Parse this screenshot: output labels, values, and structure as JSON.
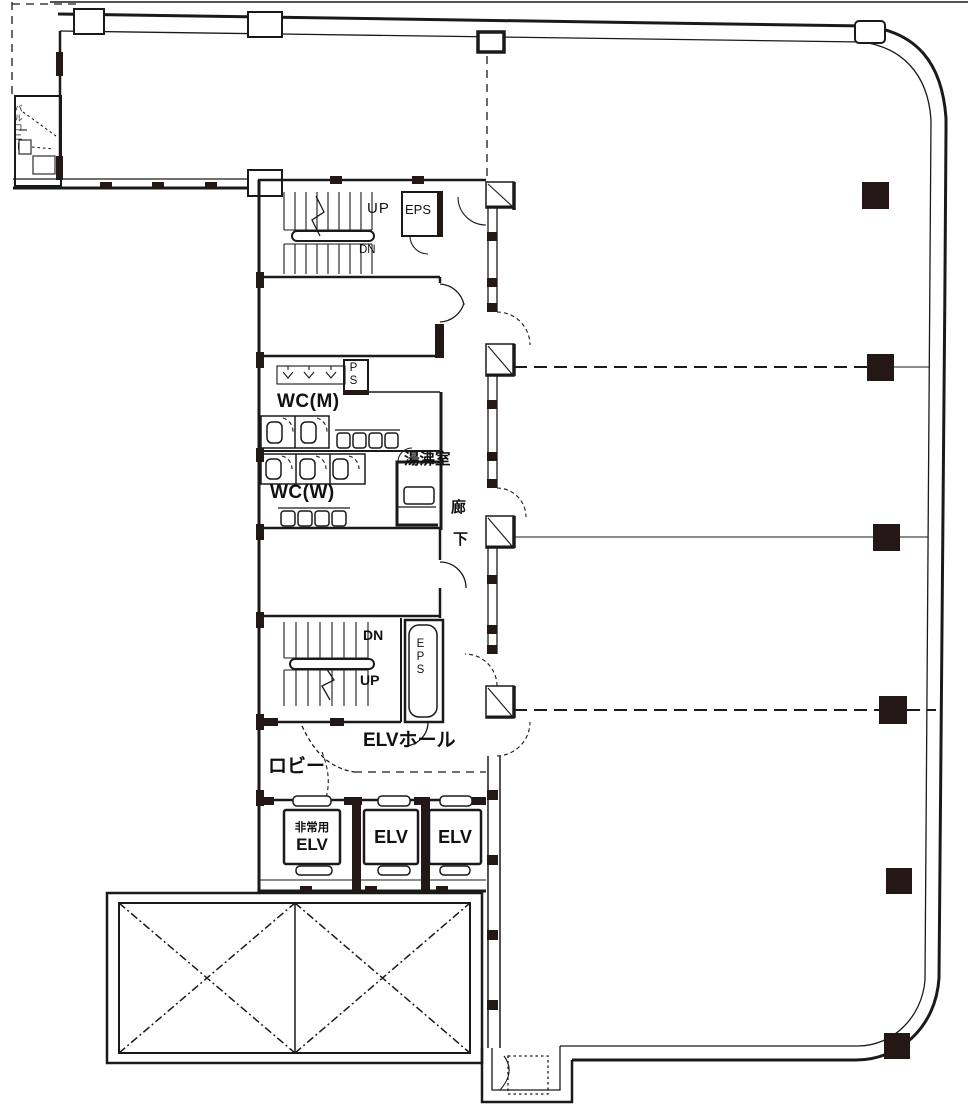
{
  "figure": {
    "type": "architectural floor plan",
    "description": "Japanese office building typical floor plan with central service core, elevator bank, stairwells, restrooms and open tenant area with columns"
  },
  "colors": {
    "background": "#ffffff",
    "line": "#1a1a1a",
    "column_fill": "#231815"
  },
  "labels": {
    "balcony": "バルコニー",
    "stair_top_up": "UP",
    "stair_top_dn": "DN",
    "eps_top": "EPS",
    "pipe_shaft": "PS",
    "wc_men": "WC(M)",
    "kitchenette": "湯沸室",
    "wc_women": "WC(W)",
    "corridor_char_1": "廊",
    "corridor_char_2": "下",
    "stair_bottom_dn": "DN",
    "stair_bottom_up": "UP",
    "eps_bottom": "EPS",
    "elevator_hall": "ELVホール",
    "lobby": "ロビー",
    "emergency_elevator_line1": "非常用",
    "emergency_elevator_line2": "ELV",
    "elevator_2": "ELV",
    "elevator_3": "ELV"
  }
}
